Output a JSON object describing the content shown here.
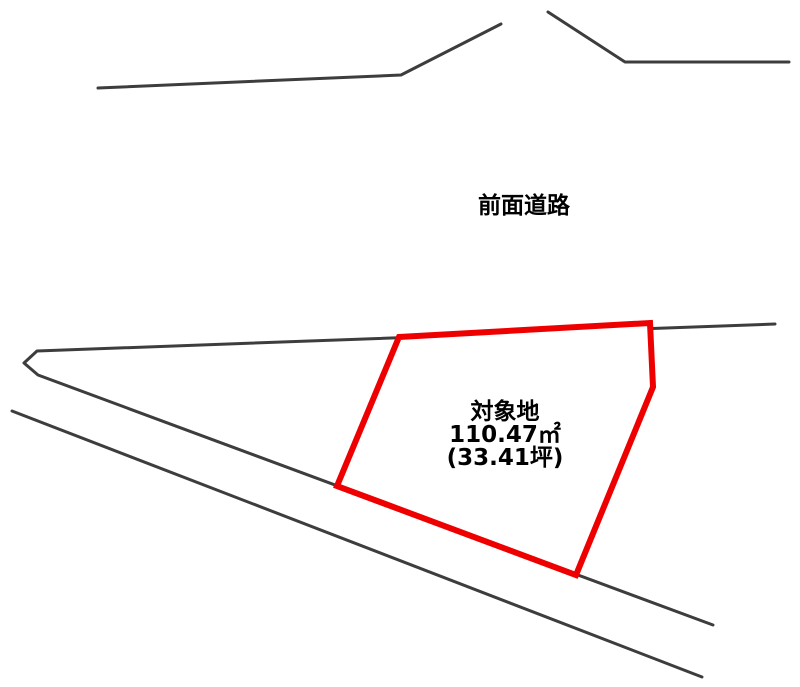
{
  "diagram": {
    "road_label": "前面道路",
    "parcel": {
      "name": "対象地",
      "area_m2": "110.47㎡",
      "area_tsubo": "(33.41坪)"
    },
    "colors": {
      "line": "#3d3d3d",
      "parcel": "#ee0000",
      "text": "#000000",
      "bg": "#ffffff"
    },
    "geometry": {
      "road_edge_upper_left": "98,88 401,75 501,24",
      "road_edge_upper_right": "548,12 625,62 789,62",
      "boundary_wedge": "775,324 37,351 24,363 38,375 713,625",
      "boundary_lower": "12,411 702,677",
      "parcel_polygon": "399,337 650,323 653,387 576,575 337,486"
    }
  }
}
